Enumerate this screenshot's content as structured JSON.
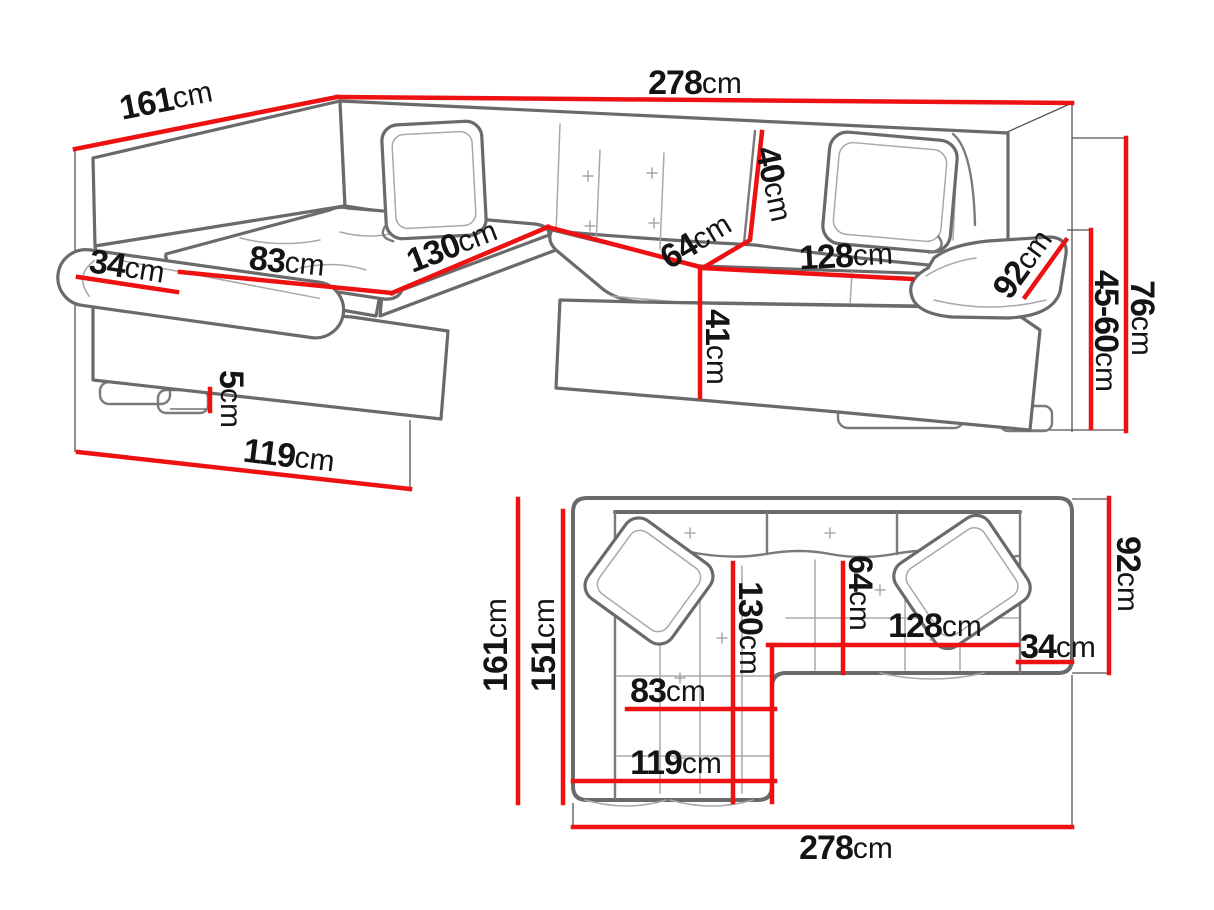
{
  "diagram": {
    "type": "furniture-dimension-diagram",
    "subject": "corner-sofa",
    "unit": "cm",
    "colors": {
      "dimension_line": "#ee1111",
      "sofa_outline": "#6a6a6a",
      "label_text": "#141414",
      "background": "#ffffff"
    }
  },
  "perspective_view": {
    "name": "3d-perspective-view",
    "dimensions": [
      {
        "name": "total-width",
        "value": "278",
        "unit": "cm",
        "line": [
          [
            337,
            97
          ],
          [
            1072,
            103
          ]
        ],
        "label": {
          "x": 695,
          "y": 83,
          "r": 0
        }
      },
      {
        "name": "total-depth",
        "value": "161",
        "unit": "cm",
        "line": [
          [
            337,
            97
          ],
          [
            75,
            149
          ]
        ],
        "label": {
          "x": 166,
          "y": 100,
          "r": -11
        }
      },
      {
        "name": "armrest-width",
        "value": "34",
        "unit": "cm",
        "line": [
          [
            78,
            277
          ],
          [
            177,
            292
          ]
        ],
        "label": {
          "x": 127,
          "y": 267,
          "r": 9
        }
      },
      {
        "name": "chaise-seat-width",
        "value": "83",
        "unit": "cm",
        "line": [
          [
            180,
            272
          ],
          [
            392,
            293
          ]
        ],
        "label": {
          "x": 287,
          "y": 262,
          "r": 6
        }
      },
      {
        "name": "chaise-length",
        "value": "130",
        "unit": "cm",
        "line": [
          [
            392,
            293
          ],
          [
            548,
            227
          ]
        ],
        "label": {
          "x": 452,
          "y": 246,
          "r": -21
        }
      },
      {
        "name": "seat-depth",
        "value": "64",
        "unit": "cm",
        "line": [
          [
            548,
            227
          ],
          [
            700,
            267
          ]
        ],
        "label": {
          "x": 696,
          "y": 241,
          "r": -31
        }
      },
      {
        "name": "backrest-height",
        "value": "40",
        "unit": "cm",
        "line": [
          [
            762,
            132
          ],
          [
            750,
            240
          ],
          [
            706,
            266
          ]
        ],
        "label": {
          "x": 774,
          "y": 184,
          "r": 78
        }
      },
      {
        "name": "seat-width",
        "value": "128",
        "unit": "cm",
        "line": [
          [
            702,
            268
          ],
          [
            912,
            279
          ]
        ],
        "label": {
          "x": 846,
          "y": 256,
          "r": -3
        }
      },
      {
        "name": "armrest-depth",
        "value": "92",
        "unit": "cm",
        "line": [
          [
            1025,
            297
          ],
          [
            1066,
            240
          ]
        ],
        "label": {
          "x": 1023,
          "y": 264,
          "r": -54
        }
      },
      {
        "name": "seat-height",
        "value": "41",
        "unit": "cm",
        "line": [
          [
            700,
            267
          ],
          [
            700,
            397
          ]
        ],
        "label": {
          "x": 717,
          "y": 347,
          "r": 90
        }
      },
      {
        "name": "total-height",
        "value": "76",
        "unit": "cm",
        "line": [
          [
            1126,
            138
          ],
          [
            1126,
            431
          ]
        ],
        "label": {
          "x": 1142,
          "y": 318,
          "r": 90
        }
      },
      {
        "name": "adjustable-height",
        "value": "45-60",
        "unit": "cm",
        "line": [
          [
            1091,
            230
          ],
          [
            1091,
            428
          ]
        ],
        "label": {
          "x": 1106,
          "y": 331,
          "r": 90
        }
      },
      {
        "name": "leg-height",
        "value": "5",
        "unit": "cm",
        "line": [
          [
            210,
            389
          ],
          [
            210,
            411
          ]
        ],
        "label": {
          "x": 231,
          "y": 399,
          "r": 90
        }
      },
      {
        "name": "chaise-front-width",
        "value": "119",
        "unit": "cm",
        "line": [
          [
            78,
            452
          ],
          [
            410,
            489
          ]
        ],
        "label": {
          "x": 289,
          "y": 456,
          "r": 7
        }
      }
    ]
  },
  "plan_view": {
    "name": "top-plan-view",
    "dimensions": [
      {
        "name": "total-depth",
        "value": "161",
        "unit": "cm",
        "line": [
          [
            518,
            499
          ],
          [
            518,
            803
          ]
        ],
        "label": {
          "x": 496,
          "y": 645,
          "r": -90
        }
      },
      {
        "name": "depth-to-backrest",
        "value": "151",
        "unit": "cm",
        "line": [
          [
            563,
            511
          ],
          [
            563,
            803
          ]
        ],
        "label": {
          "x": 544,
          "y": 645,
          "r": -90
        }
      },
      {
        "name": "chaise-length",
        "value": "130",
        "unit": "cm",
        "line": [
          [
            733,
            563
          ],
          [
            733,
            802
          ]
        ],
        "label": {
          "x": 750,
          "y": 628,
          "r": 90
        }
      },
      {
        "name": "seat-depth",
        "value": "64",
        "unit": "cm",
        "line": [
          [
            843,
            563
          ],
          [
            843,
            673
          ]
        ],
        "label": {
          "x": 860,
          "y": 593,
          "r": 90
        }
      },
      {
        "name": "seat-width",
        "value": "128",
        "unit": "cm",
        "line": [
          [
            768,
            645
          ],
          [
            1018,
            645
          ]
        ],
        "label": {
          "x": 935,
          "y": 626,
          "r": 0
        }
      },
      {
        "name": "armrest-width",
        "value": "34",
        "unit": "cm",
        "line": [
          [
            1018,
            662
          ],
          [
            1072,
            662
          ]
        ],
        "label": {
          "x": 1058,
          "y": 647,
          "r": 0
        }
      },
      {
        "name": "side-depth",
        "value": "92",
        "unit": "cm",
        "line": [
          [
            1109,
            498
          ],
          [
            1109,
            673
          ]
        ],
        "label": {
          "x": 1128,
          "y": 574,
          "r": 90
        }
      },
      {
        "name": "chaise-seat-width",
        "value": "83",
        "unit": "cm",
        "line": [
          [
            627,
            709
          ],
          [
            775,
            709
          ]
        ],
        "label": {
          "x": 668,
          "y": 691,
          "r": 0
        }
      },
      {
        "name": "chaise-width",
        "value": "119",
        "unit": "cm",
        "line": [
          [
            573,
            781
          ],
          [
            775,
            781
          ]
        ],
        "label": {
          "x": 676,
          "y": 763,
          "r": 0
        }
      },
      {
        "name": "total-width",
        "value": "278",
        "unit": "cm",
        "line": [
          [
            573,
            827
          ],
          [
            1072,
            827
          ]
        ],
        "label": {
          "x": 846,
          "y": 848,
          "r": 0
        }
      },
      {
        "name": "chaise-edge-marker",
        "value": "",
        "unit": "",
        "line": [
          [
            772,
            645
          ],
          [
            772,
            802
          ]
        ],
        "label": null
      }
    ]
  }
}
